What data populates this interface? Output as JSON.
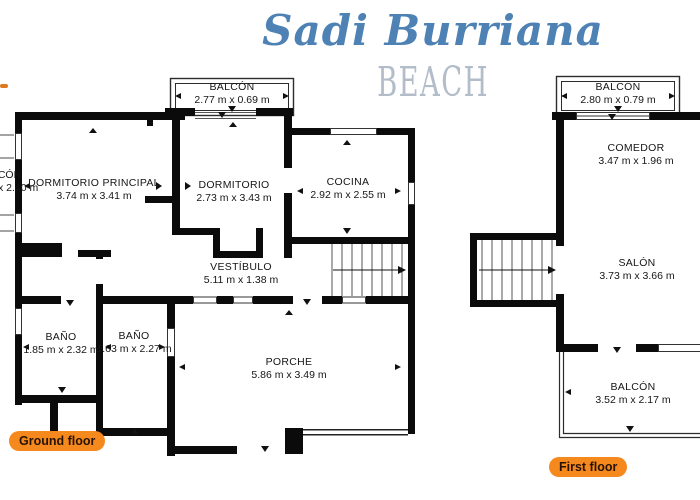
{
  "title": {
    "script": "Sadi Burriana",
    "sub": "BEACH"
  },
  "colors": {
    "title_blue": "#4e81b4",
    "beach_gray": "#b2bdc9",
    "badge_orange": "#f6891e",
    "badge_text": "#271303",
    "wall_black": "#0b0b0b"
  },
  "ground_floor": {
    "badge": "Ground floor",
    "rooms": {
      "balcon_top": {
        "name": "BALCÓN",
        "dims": "2.77 m x 0.69 m"
      },
      "balcon_left": {
        "name": "BALCÓN",
        "dims": "x 2.40 m"
      },
      "dormitorio_principal": {
        "name": "DORMITORIO PRINCIPAL",
        "dims": "3.74 m x 3.41 m"
      },
      "dormitorio": {
        "name": "DORMITORIO",
        "dims": "2.73 m x 3.43 m"
      },
      "cocina": {
        "name": "COCINA",
        "dims": "2.92 m x 2.55 m"
      },
      "vestibulo": {
        "name": "VESTÍBULO",
        "dims": "5.11 m x 1.38 m"
      },
      "bano_1": {
        "name": "BAÑO",
        "dims": "1.85 m x 2.32 m"
      },
      "bano_2": {
        "name": "BAÑO",
        "dims": "1.63 m x 2.27 m"
      },
      "porche": {
        "name": "PORCHE",
        "dims": "5.86 m x 3.49 m"
      }
    }
  },
  "first_floor": {
    "badge": "First floor",
    "rooms": {
      "balcon_top": {
        "name": "BALCÓN",
        "dims": "2.80 m x 0.79 m"
      },
      "comedor": {
        "name": "COMEDOR",
        "dims": "3.47 m x 1.96 m"
      },
      "salon": {
        "name": "SALÓN",
        "dims": "3.73 m x 3.66 m"
      },
      "balcon_bottom": {
        "name": "BALCÓN",
        "dims": "3.52 m x 2.17 m"
      }
    }
  }
}
